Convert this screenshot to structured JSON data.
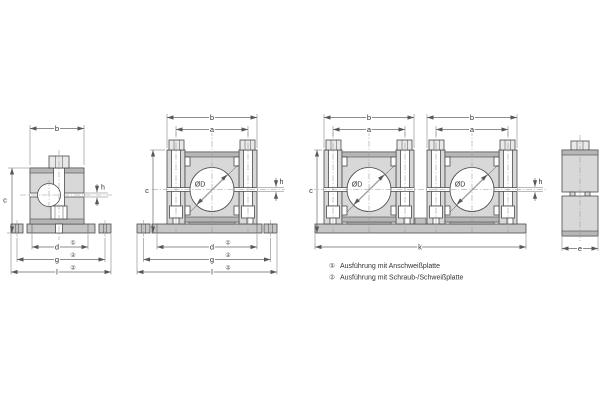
{
  "drawing": {
    "dims": {
      "a": "a",
      "b": "b",
      "c": "c",
      "d": "d",
      "e": "e",
      "g": "g",
      "h": "h",
      "k": "k",
      "l": "l",
      "diameter": "ØD"
    },
    "refs": {
      "weld": "①",
      "screw_weld": "②"
    },
    "legend": [
      {
        "ref": "①",
        "text": "Ausführung mit Anschweißplatte"
      },
      {
        "ref": "②",
        "text": "Ausführung mit Schraub-/Schweißplatte"
      }
    ],
    "colors": {
      "body_fill": "#d8d8d8",
      "body_dark_band": "#b6b6b6",
      "plate_fill": "#c6c6c6",
      "bolt_head_fill": "#e9e9e9",
      "outline": "#4a4a4a",
      "dimension_line": "#686868",
      "centerline": "#969696",
      "text": "#2f2f2f",
      "background": "#ffffff"
    }
  }
}
